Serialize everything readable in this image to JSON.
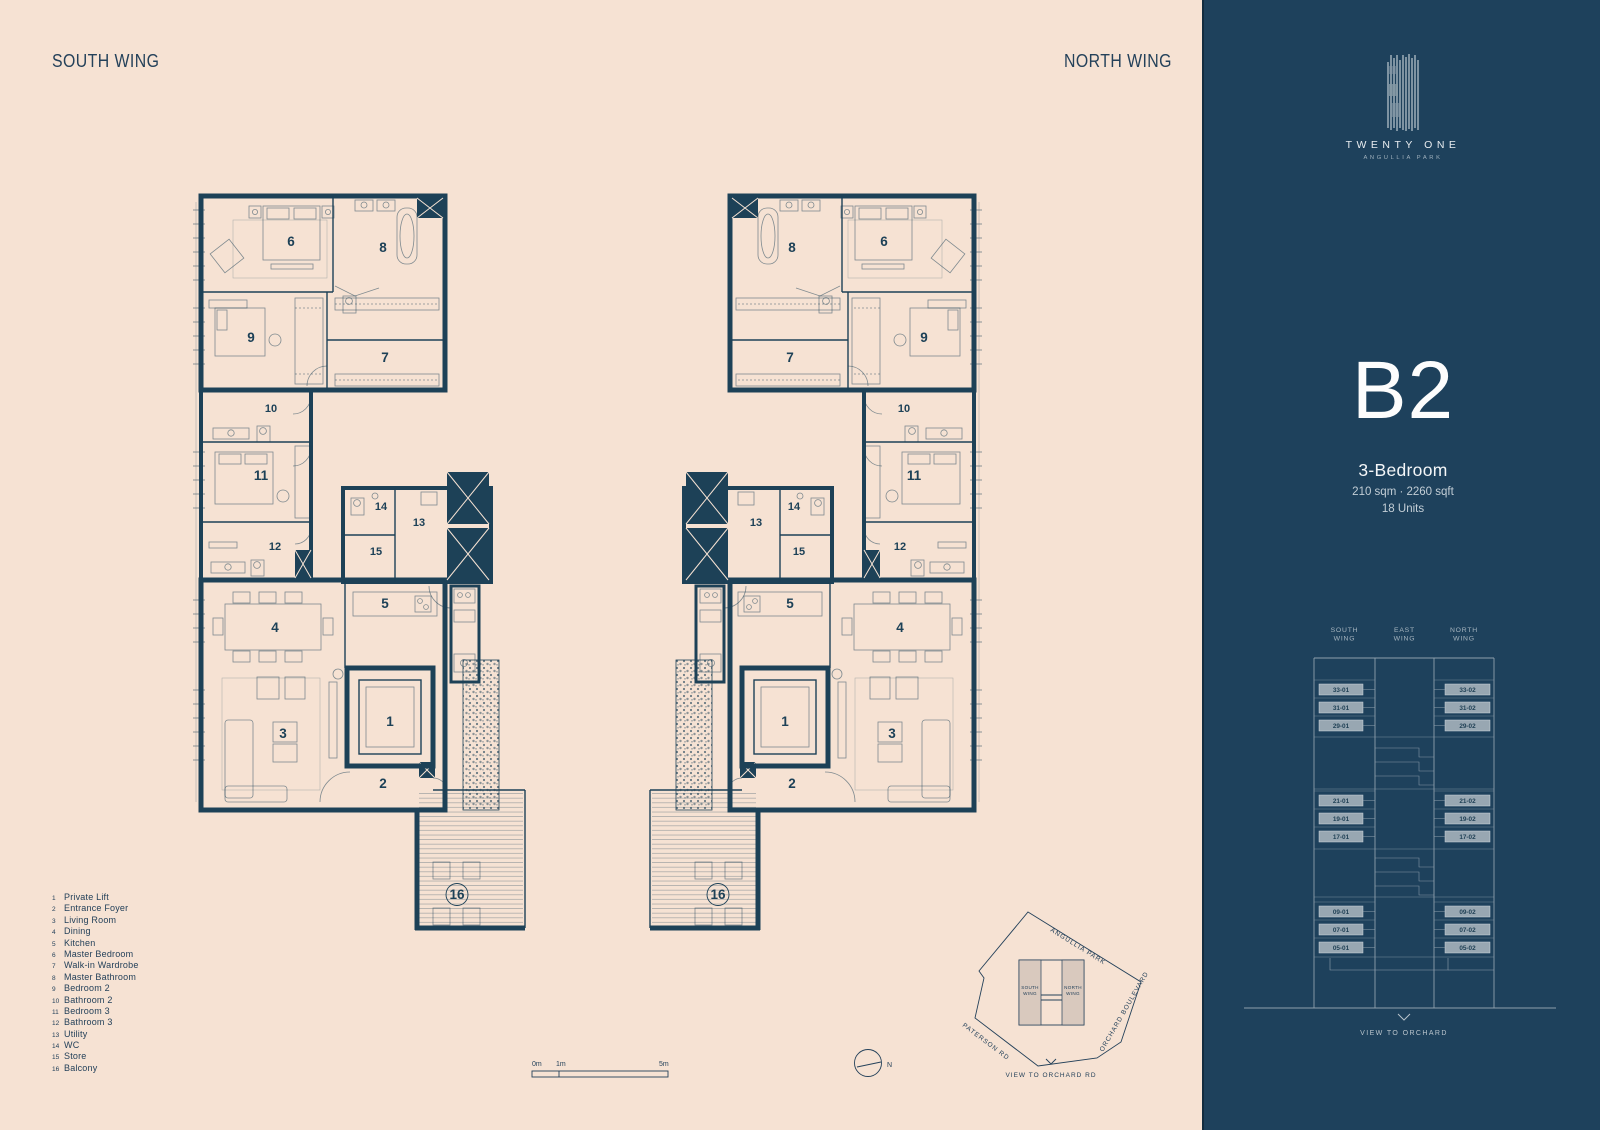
{
  "page": {
    "south_wing_header": "SOUTH WING",
    "north_wing_header": "NORTH WING"
  },
  "brand": {
    "name": "TWENTY ONE",
    "subname": "ANGULLIA PARK",
    "logo_icon": "striped-tower"
  },
  "unit": {
    "type": "B2",
    "bedrooms": "3-Bedroom",
    "area": "210 sqm · 2260 sqft",
    "count": "18 Units"
  },
  "legend": {
    "items": [
      {
        "num": "1",
        "label": "Private Lift"
      },
      {
        "num": "2",
        "label": "Entrance Foyer"
      },
      {
        "num": "3",
        "label": "Living Room"
      },
      {
        "num": "4",
        "label": "Dining"
      },
      {
        "num": "5",
        "label": "Kitchen"
      },
      {
        "num": "6",
        "label": "Master Bedroom"
      },
      {
        "num": "7",
        "label": "Walk-in Wardrobe"
      },
      {
        "num": "8",
        "label": "Master Bathroom"
      },
      {
        "num": "9",
        "label": "Bedroom 2"
      },
      {
        "num": "10",
        "label": "Bathroom 2"
      },
      {
        "num": "11",
        "label": "Bedroom 3"
      },
      {
        "num": "12",
        "label": "Bathroom 3"
      },
      {
        "num": "13",
        "label": "Utility"
      },
      {
        "num": "14",
        "label": "WC"
      },
      {
        "num": "15",
        "label": "Store"
      },
      {
        "num": "16",
        "label": "Balcony"
      }
    ]
  },
  "stack": {
    "columns": [
      [
        "SOUTH",
        "WING"
      ],
      [
        "EAST",
        "WING"
      ],
      [
        "NORTH",
        "WING"
      ]
    ],
    "south_units": [
      "33-01",
      "31-01",
      "29-01",
      "21-01",
      "19-01",
      "17-01",
      "09-01",
      "07-01",
      "05-01"
    ],
    "north_units": [
      "33-02",
      "31-02",
      "29-02",
      "21-02",
      "19-02",
      "17-02",
      "09-02",
      "07-02",
      "05-02"
    ],
    "view_label": "VIEW TO ORCHARD"
  },
  "site_plan": {
    "road_top": "ANGULLIA PARK",
    "road_left": "PATERSON RD",
    "road_right": "ORCHARD BOULEVARD",
    "south_block": [
      "SOUTH",
      "WING"
    ],
    "north_block": [
      "NORTH",
      "WING"
    ],
    "view_label": "VIEW TO ORCHARD RD"
  },
  "scale_bar": {
    "labels": [
      "0m",
      "1m",
      "5m"
    ]
  },
  "compass": {
    "label": "N"
  },
  "colors": {
    "background": "#f6e2d3",
    "ink": "#1d4157",
    "panel": "#1e415c",
    "panel_text": "#ffffff",
    "unit_box_fill": "#98a7b2",
    "stack_line": "#8fa0ad"
  }
}
